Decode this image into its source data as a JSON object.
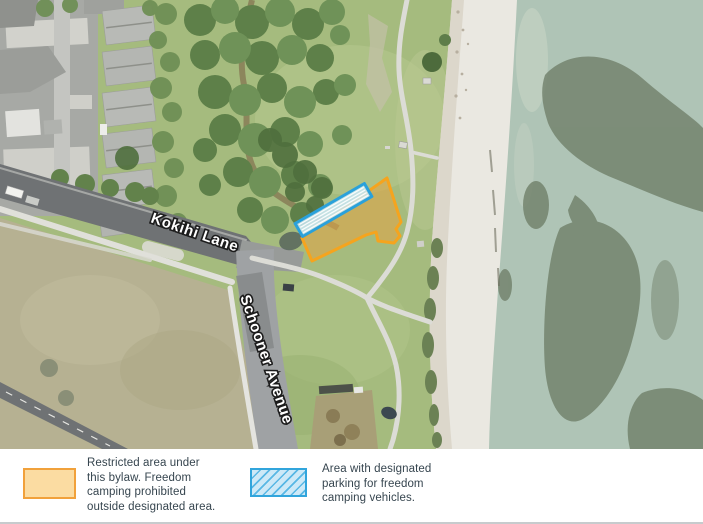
{
  "figure": {
    "type": "aerial-map-with-legend",
    "subject": "Freedom camping bylaw map - beach reserve at Kokihi Lane / Schooner Avenue"
  },
  "map": {
    "street_labels": [
      {
        "text": "Kokihi Lane"
      },
      {
        "text": "Schooner Avenue"
      }
    ],
    "overlay_colors": {
      "restricted_border": "#f5a41e",
      "restricted_fill": "#e0a646",
      "parking_border": "#2aa1db",
      "parking_fill": "#c9e7f5"
    }
  },
  "legend": {
    "items": [
      {
        "id": "restricted",
        "swatch": "orange-filled-rectangle",
        "label": "Restricted area under this bylaw. Freedom camping prohibited outside designated area."
      },
      {
        "id": "parking",
        "swatch": "blue-hatched-rectangle",
        "label": "Area with designated parking for freedom camping vehicles."
      }
    ],
    "text_color": "#36454f"
  }
}
